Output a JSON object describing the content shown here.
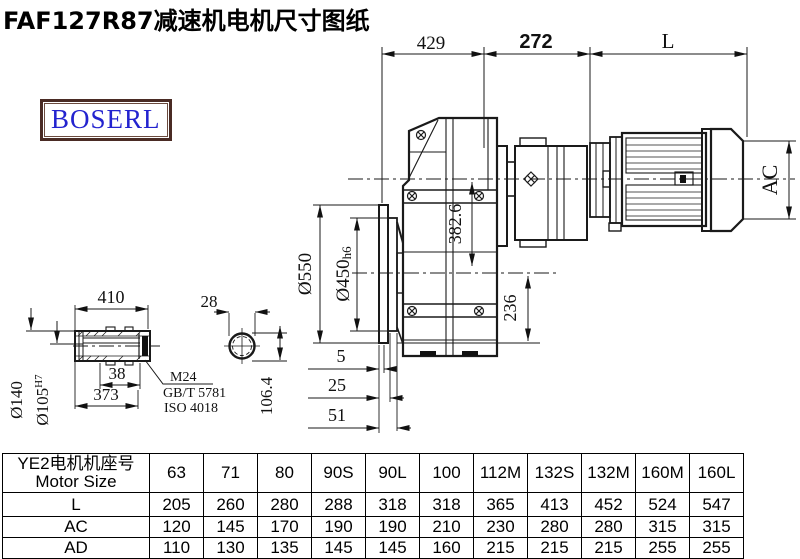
{
  "title": "FAF127R87减速机电机尺寸图纸",
  "logo": {
    "text": "BOSERL"
  },
  "main_view": {
    "dim_429": "429",
    "dim_272": "272",
    "dim_L": "L",
    "dim_AC": "AC",
    "dim_550": "Ø550",
    "dim_450": "Ø450",
    "dim_450_tol": "h6",
    "dim_382_6": "382.6",
    "dim_236": "236",
    "dim_5": "5",
    "dim_25": "25",
    "dim_51": "51"
  },
  "shaft_view": {
    "dim_410": "410",
    "dim_38": "38",
    "dim_373": "373",
    "dim_140": "Ø140",
    "dim_105": "Ø105",
    "dim_105_tol": "H7",
    "note_m24": "M24",
    "note_gb": "GB/T 5781",
    "note_iso": "ISO 4018"
  },
  "section_view": {
    "dim_28": "28",
    "dim_106_4": "106.4"
  },
  "table": {
    "header_line1": "YE2电机机座号",
    "header_line2": "Motor Size",
    "columns": [
      "63",
      "71",
      "80",
      "90S",
      "90L",
      "100",
      "112M",
      "132S",
      "132M",
      "160M",
      "160L"
    ],
    "rows": [
      {
        "label": "L",
        "values": [
          "205",
          "260",
          "280",
          "288",
          "318",
          "318",
          "365",
          "413",
          "452",
          "524",
          "547"
        ]
      },
      {
        "label": "AC",
        "values": [
          "120",
          "145",
          "170",
          "190",
          "190",
          "210",
          "230",
          "280",
          "280",
          "315",
          "315"
        ]
      },
      {
        "label": "AD",
        "values": [
          "110",
          "130",
          "135",
          "145",
          "145",
          "160",
          "215",
          "215",
          "215",
          "255",
          "255"
        ]
      }
    ]
  }
}
